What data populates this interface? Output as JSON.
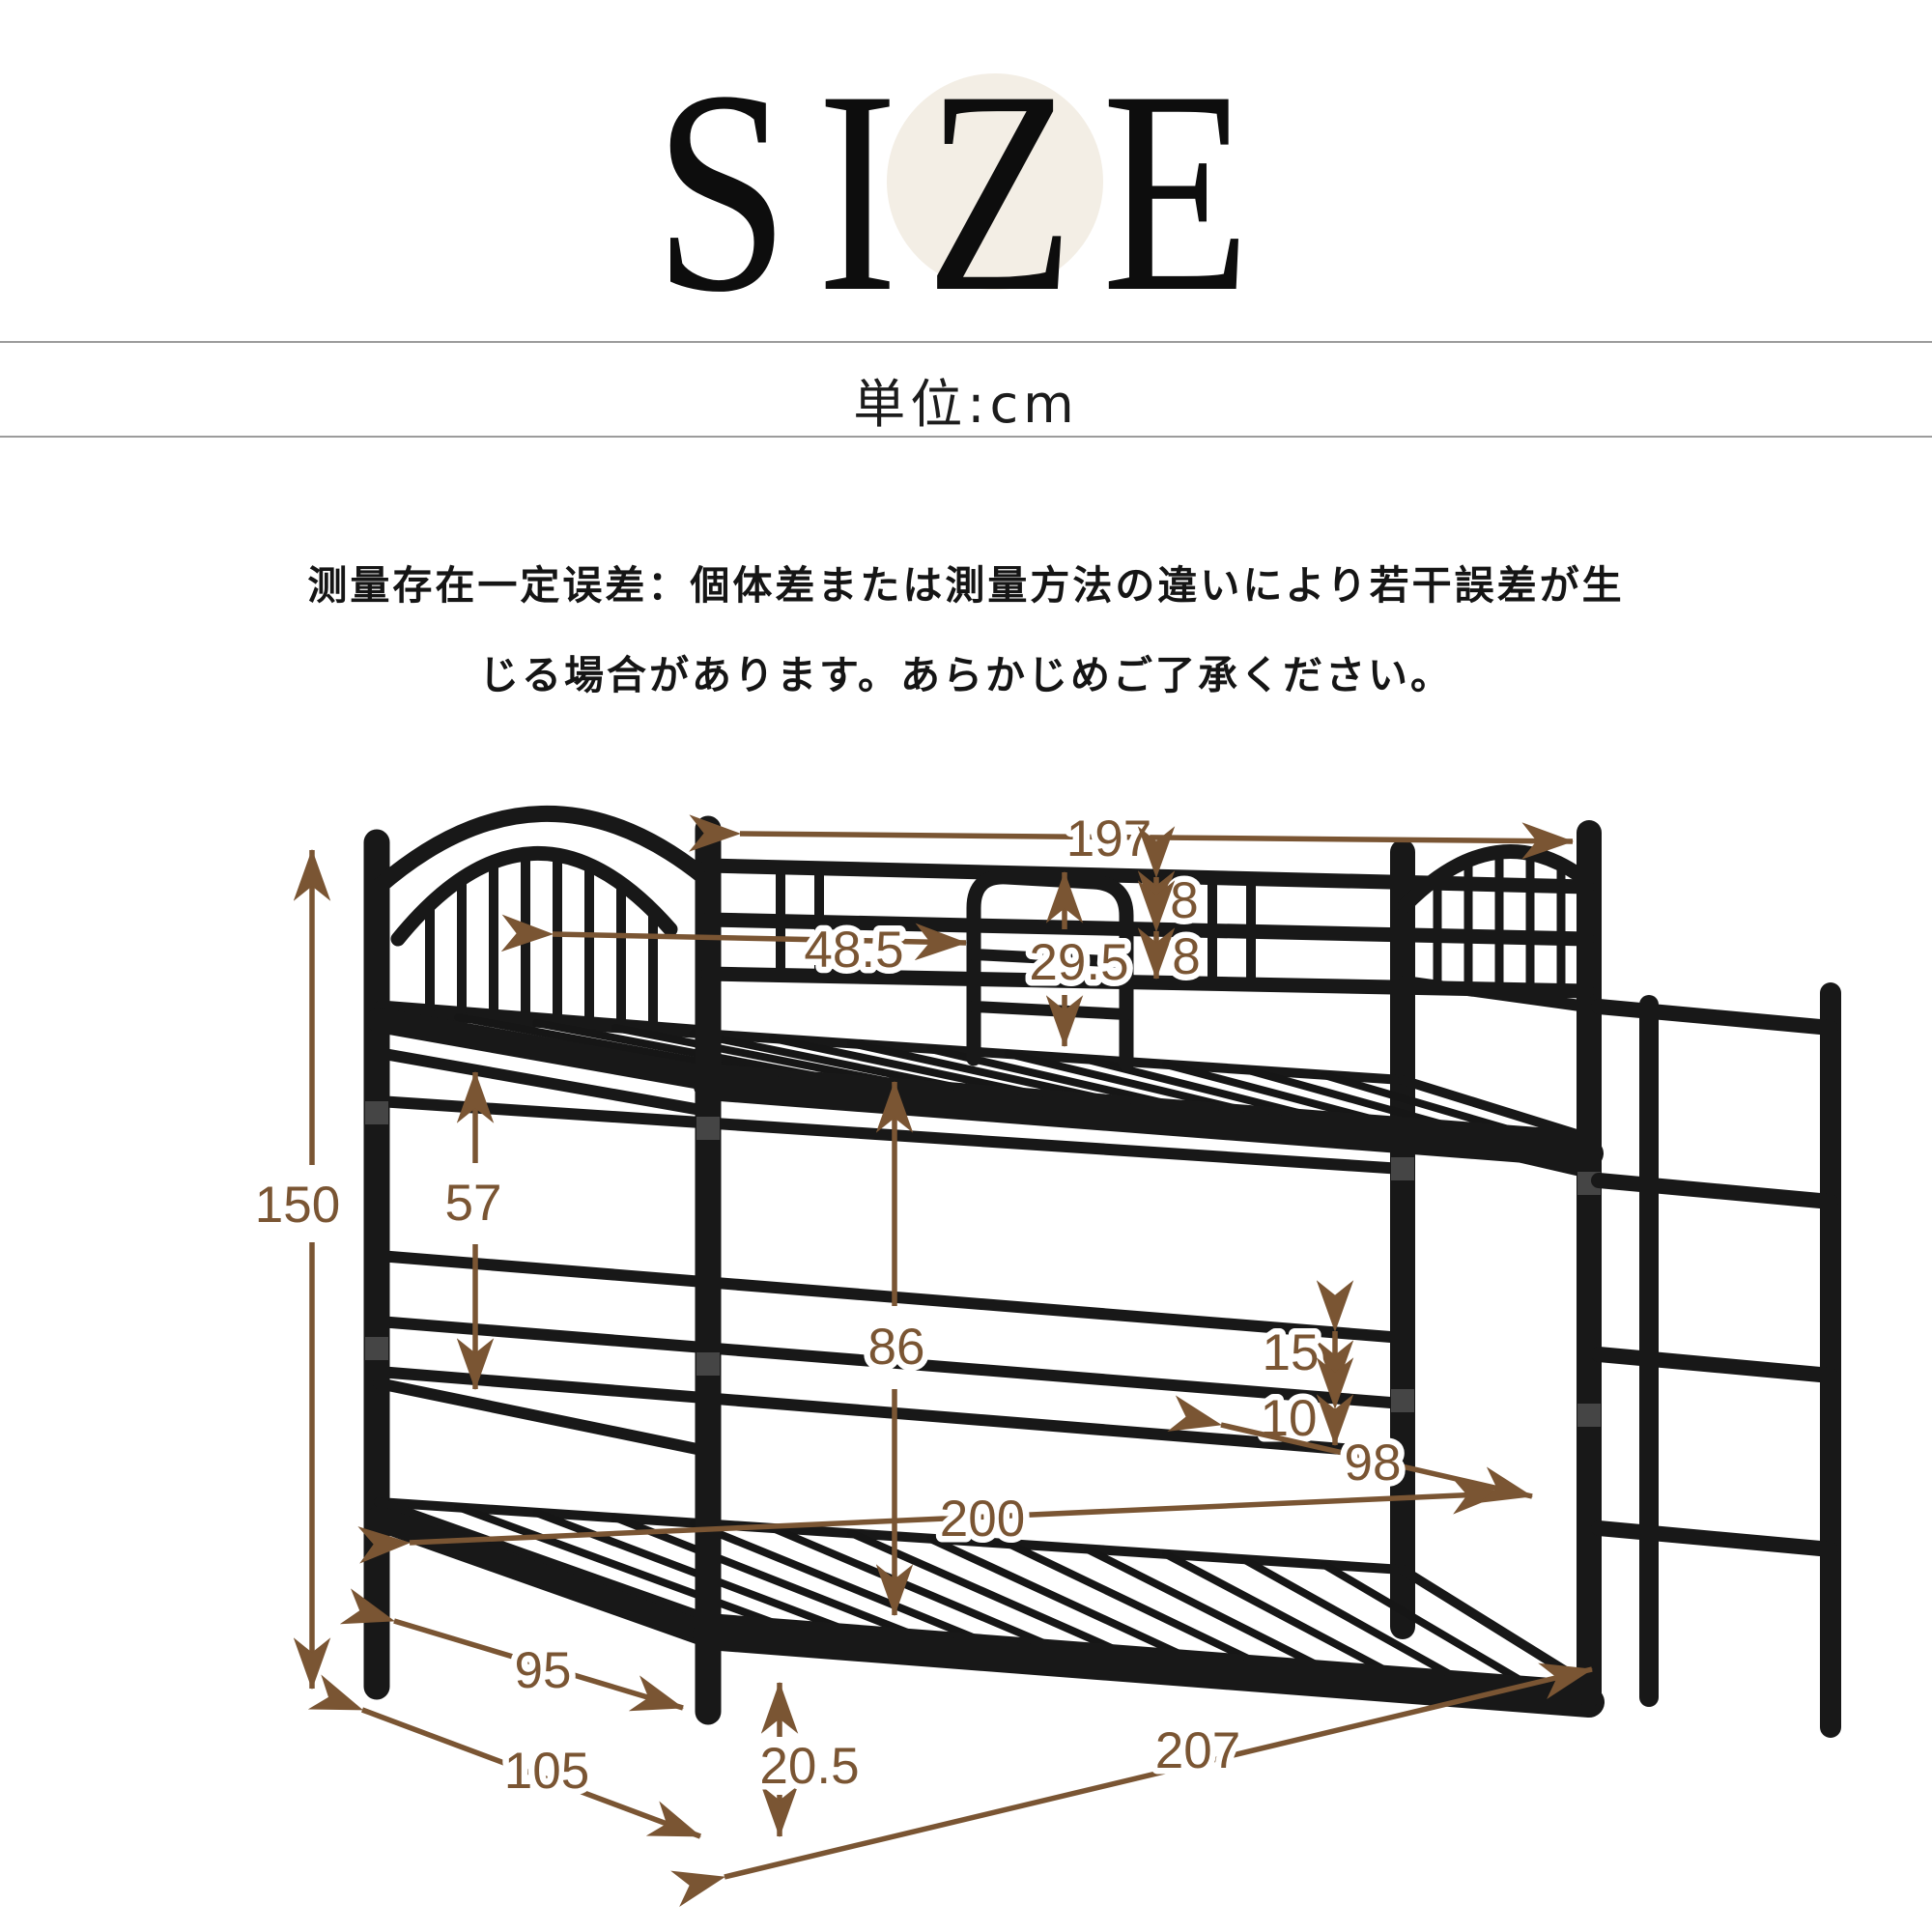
{
  "title": {
    "text": "SIZE"
  },
  "unit_label": "単位:cm",
  "disclaimer": {
    "line1": "测量存在一定误差：個体差または測量方法の違いにより若干誤差が生",
    "line2": "じる場合があります。あらかじめご了承ください。"
  },
  "colors": {
    "dimension_brown": "#7a5533",
    "bed_black": "#181818",
    "accent_circle": "#f3eee5",
    "divider_gray": "#9c9c9c"
  },
  "diagram": {
    "subject": "metal bunk bed",
    "unit": "cm",
    "dims": {
      "length_top": "197",
      "guard_rail_gap": "48.5",
      "safety_rail_height": "29.5",
      "rail_spacing_a": "8",
      "rail_spacing_b": "8",
      "total_height": "150",
      "upper_clearance": "57",
      "bunk_clearance": "86",
      "back_rail_gap_a": "15",
      "back_rail_gap_b": "10",
      "inner_length": "200",
      "end_width": "98",
      "inner_width": "95",
      "total_depth": "105",
      "base_height": "20.5",
      "total_length": "207"
    }
  }
}
